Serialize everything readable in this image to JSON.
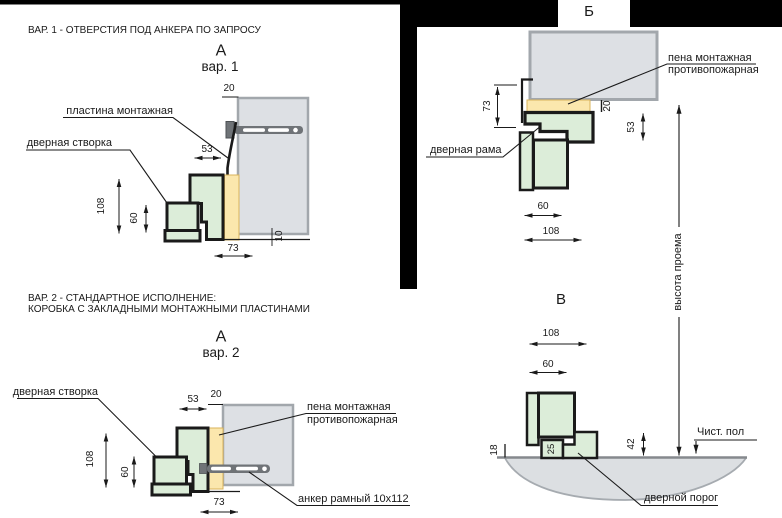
{
  "colors": {
    "green_fill": "#dcedd9",
    "yellow_fill": "#fbe7ad",
    "yellow_border": "#d9b35a",
    "wall_fill": "#dde0e4",
    "wall_border": "#a2a7ac",
    "line": "#1a1a1a",
    "metal": "#6f7377",
    "floor_fill": "#dcdfe2",
    "floor_line": "#85898d",
    "mask": "#000000"
  },
  "headers": {
    "var1": "ВАР. 1 - ОТВЕРСТИЯ ПОД АНКЕРА ПО ЗАПРОСУ",
    "var2_line1": "ВАР. 2 - СТАНДАРТНОЕ ИСПОЛНЕНИЕ:",
    "var2_line2": "КОРОБКА С ЗАКЛАДНЫМИ МОНТАЖНЫМИ ПЛАСТИНАМИ"
  },
  "a1": {
    "title": "А",
    "subtitle": "вар. 1",
    "labels": {
      "plate": "пластина монтажная",
      "leaf": "дверная створка"
    },
    "dims": {
      "top": "20",
      "gap": "53",
      "height": "108",
      "leaf_height": "60",
      "width": "73",
      "offset": "10"
    }
  },
  "a2": {
    "title": "А",
    "subtitle": "вар. 2",
    "labels": {
      "leaf": "дверная створка",
      "foam_line1": "пена монтажная",
      "foam_line2": "противопожарная",
      "anchor": "анкер рамный 10x112"
    },
    "dims": {
      "gap": "53",
      "top": "20",
      "height": "108",
      "leaf_height": "60",
      "width": "73"
    }
  },
  "b": {
    "title": "Б",
    "labels": {
      "foam_line1": "пена монтажная",
      "foam_line2": "противопожарная",
      "frame": "дверная рама",
      "opening_height": "высота проема"
    },
    "dims": {
      "frame_depth": "73",
      "foam": "20",
      "tab": "53",
      "leaf": "60",
      "total": "108"
    }
  },
  "v": {
    "title": "В",
    "labels": {
      "floor": "Чист. пол",
      "threshold": "дверной порог"
    },
    "dims": {
      "total": "108",
      "leaf": "60",
      "floor_gap": "18",
      "sill": "25",
      "height": "42"
    }
  }
}
